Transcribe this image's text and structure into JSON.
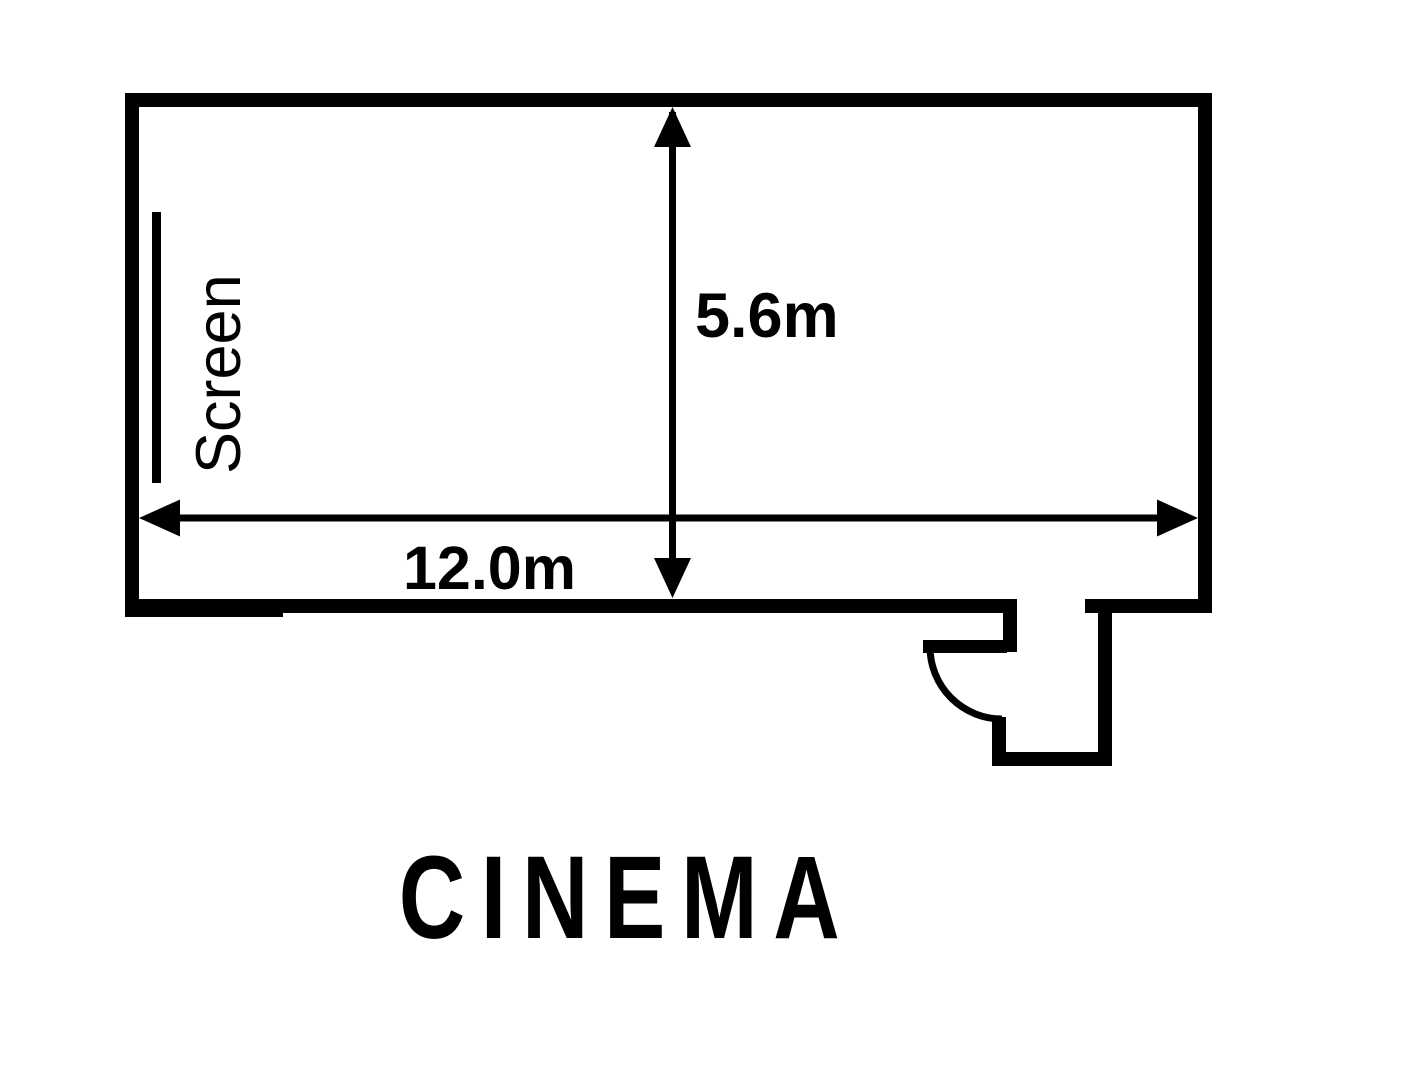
{
  "diagram": {
    "type": "floor-plan",
    "room_label": "CINEMA",
    "screen_label": "Screen",
    "dimensions": {
      "width_label": "12.0m",
      "height_label": "5.6m",
      "width_m": 12.0,
      "height_m": 5.6
    },
    "features": [
      "screen",
      "door"
    ],
    "colors": {
      "ink": "#000000",
      "background": "#ffffff"
    }
  }
}
